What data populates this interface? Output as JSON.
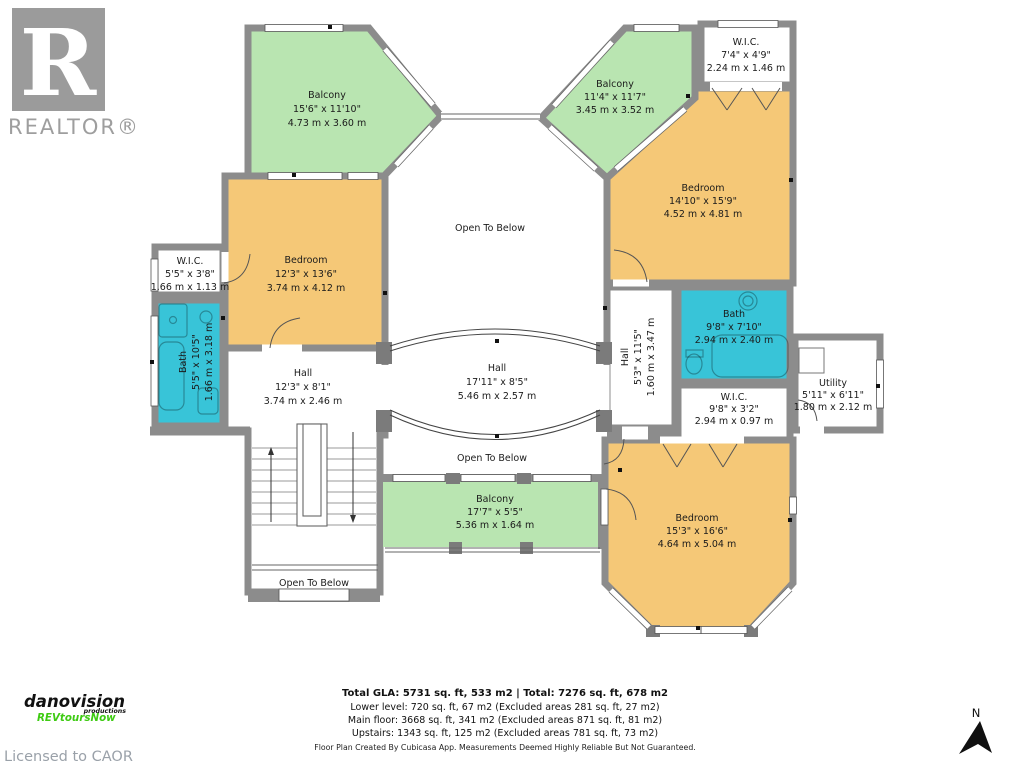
{
  "branding": {
    "realtor_r": "R",
    "realtor_text": "REALTOR®",
    "producer_line1": "danovision",
    "producer_line2": "productions",
    "producer_line3": "REVtoursNow",
    "license_text": "Licensed to CAOR",
    "north_label": "N"
  },
  "colors": {
    "balcony": "#b9e5b1",
    "bedroom": "#f5c877",
    "bath": "#38c4d8",
    "wall": "#8c8c8c",
    "producer_green": "#3ecb13",
    "logo_gray": "#9b9b9b"
  },
  "rooms": {
    "balcony_tl": {
      "name": "Balcony",
      "imperial": "15'6\" x 11'10\"",
      "metric": "4.73 m x 3.60 m"
    },
    "bedroom_tl": {
      "name": "Bedroom",
      "imperial": "12'3\" x 13'6\"",
      "metric": "3.74 m x 4.12 m"
    },
    "wic_l": {
      "name": "W.I.C.",
      "imperial": "5'5\" x 3'8\"",
      "metric": "1.66 m x 1.13 m"
    },
    "bath_l": {
      "name": "Bath",
      "imperial": "5'5\" x 10'5\"",
      "metric": "1.66 m x 3.18 m"
    },
    "hall_l": {
      "name": "Hall",
      "imperial": "12'3\" x 8'1\"",
      "metric": "3.74 m x 2.46 m"
    },
    "hall_c": {
      "name": "Hall",
      "imperial": "17'11\" x 8'5\"",
      "metric": "5.46 m x 2.57 m"
    },
    "balcony_b": {
      "name": "Balcony",
      "imperial": "17'7\" x 5'5\"",
      "metric": "5.36 m x 1.64 m"
    },
    "balcony_tr": {
      "name": "Balcony",
      "imperial": "11'4\" x 11'7\"",
      "metric": "3.45 m x 3.52 m"
    },
    "wic_tr": {
      "name": "W.I.C.",
      "imperial": "7'4\" x 4'9\"",
      "metric": "2.24 m x 1.46 m"
    },
    "bedroom_tr": {
      "name": "Bedroom",
      "imperial": "14'10\" x 15'9\"",
      "metric": "4.52 m x 4.81 m"
    },
    "hall_r": {
      "name": "Hall",
      "imperial": "5'3\" x 11'5\"",
      "metric": "1.60 m x 3.47 m"
    },
    "bath_r": {
      "name": "Bath",
      "imperial": "9'8\" x 7'10\"",
      "metric": "2.94 m x 2.40 m"
    },
    "wic_r": {
      "name": "W.I.C.",
      "imperial": "9'8\" x 3'2\"",
      "metric": "2.94 m x 0.97 m"
    },
    "utility": {
      "name": "Utility",
      "imperial": "5'11\" x 6'11\"",
      "metric": "1.80 m x 2.12 m"
    },
    "bedroom_br": {
      "name": "Bedroom",
      "imperial": "15'3\" x 16'6\"",
      "metric": "4.64 m x 5.04 m"
    }
  },
  "open": {
    "top": "Open To Below",
    "bottom": "Open To Below",
    "stairs": "Open To Below"
  },
  "footer": {
    "total": "Total GLA: 5731 sq. ft, 533 m2 | Total: 7276 sq. ft, 678 m2",
    "lower": "Lower level: 720 sq. ft, 67 m2 (Excluded areas 281 sq. ft, 27 m2)",
    "main": "Main floor: 3668 sq. ft, 341 m2 (Excluded areas 871 sq. ft, 81 m2)",
    "upstairs": "Upstairs: 1343 sq. ft, 125 m2 (Excluded areas 781 sq. ft, 73 m2)",
    "disclaimer": "Floor Plan Created By Cubicasa App. Measurements Deemed Highly Reliable But Not Guaranteed."
  }
}
